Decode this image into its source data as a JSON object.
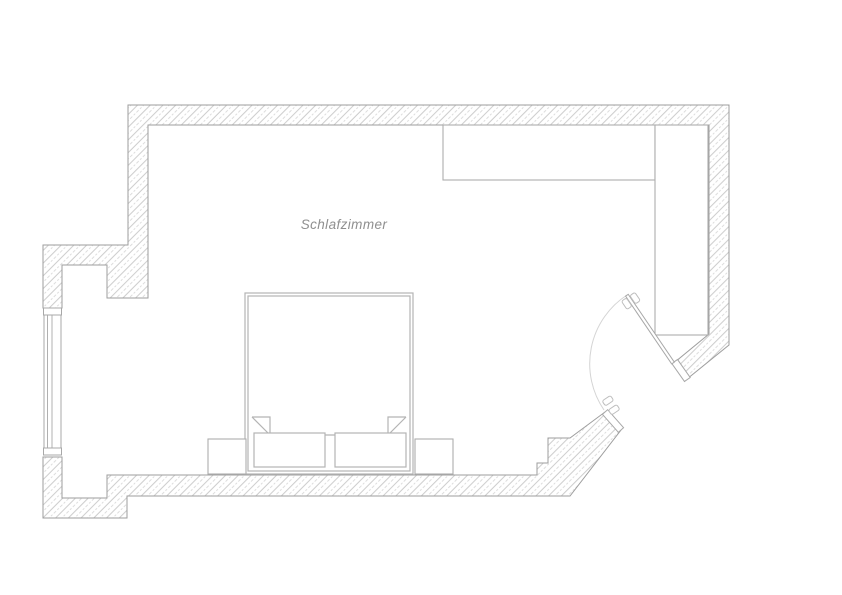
{
  "room": {
    "label": "Schlafzimmer"
  },
  "colors": {
    "background": "#ffffff",
    "wall_outline": "#9e9e9e",
    "hatch_line": "#c6c6c6",
    "furniture_line": "#aeaeae",
    "bed_line": "#b4b4b4",
    "door_line": "#a8a8a8",
    "door_arc": "#d4d4d4",
    "label_text": "#8f8f8f"
  }
}
